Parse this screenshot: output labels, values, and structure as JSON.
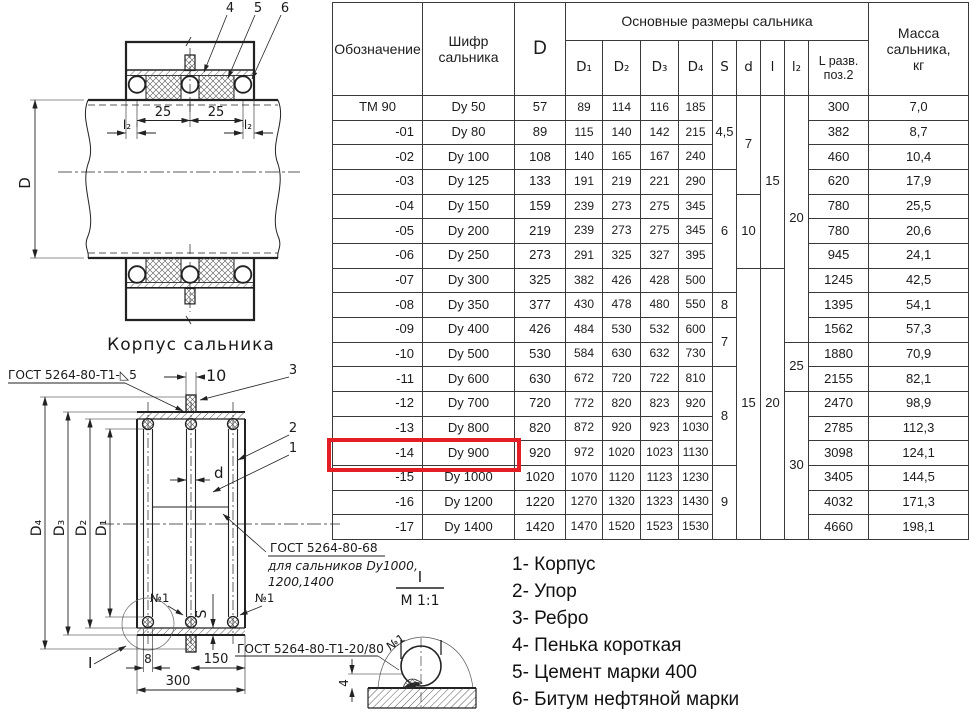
{
  "table": {
    "header": {
      "designation": "Обозначение",
      "code": "Шифр\nсальника",
      "D": "D",
      "group": "Основные размеры сальника",
      "sub": [
        "D₁",
        "D₂",
        "D₃",
        "D₄",
        "S",
        "d",
        "l",
        "l₂",
        "L разв.\nпоз.2"
      ],
      "mass": "Масса\nсальника,\nкг"
    },
    "rows": [
      {
        "designation": "ТМ 90",
        "code": "Dy 50",
        "D": "57",
        "D1": "89",
        "D2": "114",
        "D3": "116",
        "D4": "185",
        "L": "300",
        "mass": "7,0"
      },
      {
        "designation": "-01",
        "code": "Dy 80",
        "D": "89",
        "D1": "115",
        "D2": "140",
        "D3": "142",
        "D4": "215",
        "L": "382",
        "mass": "8,7"
      },
      {
        "designation": "-02",
        "code": "Dy 100",
        "D": "108",
        "D1": "140",
        "D2": "165",
        "D3": "167",
        "D4": "240",
        "L": "460",
        "mass": "10,4"
      },
      {
        "designation": "-03",
        "code": "Dy 125",
        "D": "133",
        "D1": "191",
        "D2": "219",
        "D3": "221",
        "D4": "290",
        "L": "620",
        "mass": "17,9"
      },
      {
        "designation": "-04",
        "code": "Dy 150",
        "D": "159",
        "D1": "239",
        "D2": "273",
        "D3": "275",
        "D4": "345",
        "L": "780",
        "mass": "25,5"
      },
      {
        "designation": "-05",
        "code": "Dy 200",
        "D": "219",
        "D1": "239",
        "D2": "273",
        "D3": "275",
        "D4": "345",
        "L": "780",
        "mass": "20,6"
      },
      {
        "designation": "-06",
        "code": "Dy 250",
        "D": "273",
        "D1": "291",
        "D2": "325",
        "D3": "327",
        "D4": "395",
        "L": "945",
        "mass": "24,1"
      },
      {
        "designation": "-07",
        "code": "Dy 300",
        "D": "325",
        "D1": "382",
        "D2": "426",
        "D3": "428",
        "D4": "500",
        "L": "1245",
        "mass": "42,5"
      },
      {
        "designation": "-08",
        "code": "Dy 350",
        "D": "377",
        "D1": "430",
        "D2": "478",
        "D3": "480",
        "D4": "550",
        "L": "1395",
        "mass": "54,1"
      },
      {
        "designation": "-09",
        "code": "Dy 400",
        "D": "426",
        "D1": "484",
        "D2": "530",
        "D3": "532",
        "D4": "600",
        "L": "1562",
        "mass": "57,3"
      },
      {
        "designation": "-10",
        "code": "Dy 500",
        "D": "530",
        "D1": "584",
        "D2": "630",
        "D3": "632",
        "D4": "730",
        "L": "1880",
        "mass": "70,9"
      },
      {
        "designation": "-11",
        "code": "Dy 600",
        "D": "630",
        "D1": "672",
        "D2": "720",
        "D3": "722",
        "D4": "810",
        "L": "2155",
        "mass": "82,1"
      },
      {
        "designation": "-12",
        "code": "Dy 700",
        "D": "720",
        "D1": "772",
        "D2": "820",
        "D3": "823",
        "D4": "920",
        "L": "2470",
        "mass": "98,9"
      },
      {
        "designation": "-13",
        "code": "Dy 800",
        "D": "820",
        "D1": "872",
        "D2": "920",
        "D3": "923",
        "D4": "1030",
        "L": "2785",
        "mass": "112,3"
      },
      {
        "designation": "-14",
        "code": "Dy 900",
        "D": "920",
        "D1": "972",
        "D2": "1020",
        "D3": "1023",
        "D4": "1130",
        "L": "3098",
        "mass": "124,1"
      },
      {
        "designation": "-15",
        "code": "Dy 1000",
        "D": "1020",
        "D1": "1070",
        "D2": "1120",
        "D3": "1123",
        "D4": "1230",
        "L": "3405",
        "mass": "144,5"
      },
      {
        "designation": "-16",
        "code": "Dy 1200",
        "D": "1220",
        "D1": "1270",
        "D2": "1320",
        "D3": "1323",
        "D4": "1430",
        "L": "4032",
        "mass": "171,3"
      },
      {
        "designation": "-17",
        "code": "Dy 1400",
        "D": "1420",
        "D1": "1470",
        "D2": "1520",
        "D3": "1523",
        "D4": "1530",
        "L": "4660",
        "mass": "198,1"
      }
    ],
    "merged": {
      "S": [
        {
          "value": "4,5",
          "start": 0,
          "span": 3
        },
        {
          "value": "6",
          "start": 3,
          "span": 5
        },
        {
          "value": "8",
          "start": 8,
          "span": 1
        },
        {
          "value": "7",
          "start": 9,
          "span": 2
        },
        {
          "value": "8",
          "start": 11,
          "span": 4
        },
        {
          "value": "9",
          "start": 15,
          "span": 3
        }
      ],
      "d": [
        {
          "value": "7",
          "start": 0,
          "span": 4
        },
        {
          "value": "10",
          "start": 4,
          "span": 3
        },
        {
          "value": "15",
          "start": 7,
          "span": 11
        }
      ],
      "l": [
        {
          "value": "15",
          "start": 0,
          "span": 7
        },
        {
          "value": "20",
          "start": 7,
          "span": 11
        }
      ],
      "l2": [
        {
          "value": "20",
          "start": 0,
          "span": 10
        },
        {
          "value": "25",
          "start": 10,
          "span": 2
        },
        {
          "value": "30",
          "start": 12,
          "span": 6
        }
      ]
    },
    "highlight_row": 14,
    "highlight_color": "#e31e24"
  },
  "top_drawing": {
    "callout_4": "4",
    "callout_5": "5",
    "callout_6": "6",
    "dim_25_a": "25",
    "dim_25_b": "25",
    "dim_l2_a": "l₂",
    "dim_l2_b": "l₂",
    "dim_D": "D",
    "caption": "Корпус сальника"
  },
  "bottom_drawing": {
    "weld_label_top": "ГОСТ 5264-80-Т1-◺5",
    "dim_10": "10",
    "callout_3": "3",
    "callout_2": "2",
    "callout_1": "1",
    "dim_D4": "D₄",
    "dim_D3": "D₃",
    "dim_D2": "D₂",
    "dim_D1": "D₁",
    "dim_d": "d",
    "note_line1": "ГОСТ 5264-80-68",
    "note_line2": "для сальников Dy1000,",
    "note_line3": "1200,1400",
    "weld_no1_left": "№1",
    "weld_no1_right": "№1",
    "dim_S": "S",
    "dim_8": "8",
    "dim_150": "150",
    "dim_300": "300",
    "weld_label_bottom": "ГОСТ 5264-80-Т1-20/80",
    "detail_callout": "I"
  },
  "detail_view": {
    "label": "I",
    "scale": "М 1:1",
    "dim_4": "4",
    "weld_no1": "№1"
  },
  "legend": {
    "items": [
      "1- Корпус",
      "2- Упор",
      "3- Ребро",
      "4- Пенька короткая",
      "5- Цемент марки 400",
      "6- Битум нефтяной марки"
    ]
  }
}
